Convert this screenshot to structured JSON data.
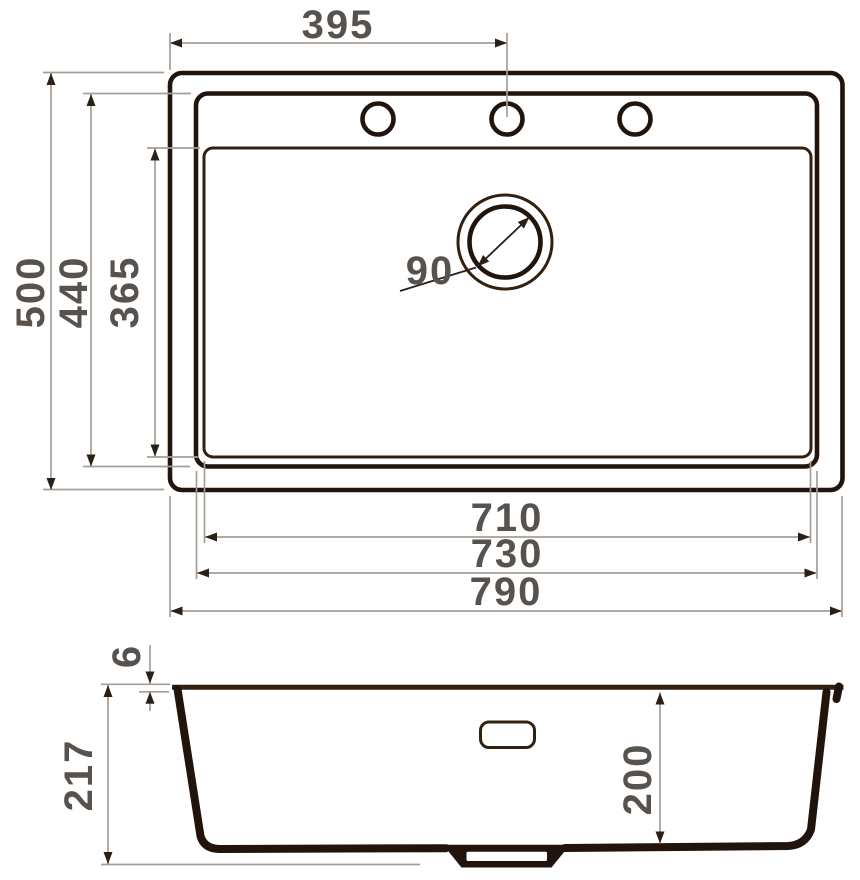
{
  "colors": {
    "line": "#20140c",
    "line2": "#33200f",
    "dim": "#a49e97",
    "arrow": "#2a2017",
    "label": "#57524d",
    "bg": "#ffffff"
  },
  "plan_view": {
    "dim_hole_offset": "395",
    "dim_overall_depth": "500",
    "dim_bowl_outer_depth": "440",
    "dim_bowl_inner_depth": "365",
    "dim_drain_diameter": "90",
    "dim_bowl_inner_width": "710",
    "dim_bowl_outer_width": "730",
    "dim_overall_width": "790"
  },
  "section_view": {
    "dim_rim_thickness": "6",
    "dim_overall_height": "217",
    "dim_bowl_depth": "200"
  }
}
